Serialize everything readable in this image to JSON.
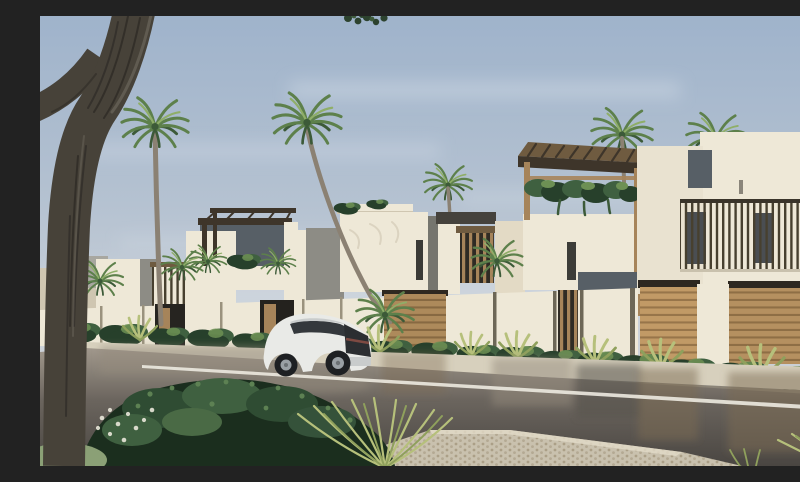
{
  "scene": {
    "description": "Daytime architectural rendering of a receding row of modern cream-white villas with rooftop timber pergolas and hanging greenery, palm trees behind, timber louver screens and slatted garage doors at street level, hedges and agaves along garden walls, a wet asphalt street with a white painted lane line reflecting the buildings, a white luxury SUV driving away, a paver walkway, ornamental grasses and a dense dark shrub in the foreground, and a large leaning tree trunk framing the left edge.",
    "environment": {
      "sky": "clear pale blue with thin cloud haze",
      "lighting": "warm sunlight from the right",
      "street_condition": "wet after rain, reflective"
    },
    "objects": [
      "foreground tree trunk with forked branch",
      "tall date palm trees",
      "row of modern white villas",
      "rooftop wooden pergolas",
      "hanging planter greenery garland",
      "vertical timber louver screen",
      "timber slat garage doors",
      "cream garden walls with timber entry doors",
      "hedge and agave planting strip",
      "concrete curb and far sidewalk",
      "wet asphalt street with reflections",
      "white painted lane line",
      "cobblestone paver walkway",
      "white SUV seen from rear three-quarter",
      "ornamental grass tufts",
      "dense foreground shrub with white blossoms"
    ]
  },
  "palette": {
    "sky_top": "#9fb3cb",
    "sky_mid": "#b5c2d1",
    "sky_horizon": "#ccd2d9",
    "cloud_haze": "#dde4ec",
    "wall_sun": "#eee8d7",
    "wall_warm": "#e3dac5",
    "wall_shade": "#cfc6b1",
    "wall_gray": "#a8a7a0",
    "panel_dark": "#575f66",
    "panel_gray": "#8d8c85",
    "wood_dark": "#3e352a",
    "wood_mid": "#6f5b40",
    "wood_light": "#a6845a",
    "garage_wood": "#c19a66",
    "garage_line": "#906e45",
    "garage_frame": "#2e2820",
    "green_dark": "#27402b",
    "green_mid": "#3f6040",
    "green_light": "#6d9054",
    "palm_green": "#5d804b",
    "palm_dark": "#3c5a38",
    "palm_light": "#8fae68",
    "palm_trunk": "#8b8173",
    "tree_trunk": "#474239",
    "tree_bark_dark": "#2e2b26",
    "tree_edge_light": "#6b665b",
    "road_light": "#a39a8e",
    "road_mid": "#6b655e",
    "road_dark": "#4a4642",
    "reflect_brown": "#7d6b51",
    "reflect_light": "#948c7e",
    "curb_light": "#d7d0bd",
    "curb_shadow": "#8b8477",
    "line_white": "#eae7dd",
    "paver": "#c9c1ae",
    "paver_dot": "#ab9f87",
    "grass_light": "#b6c07b",
    "grass_dark": "#8fa05c",
    "car_white": "#e9eae7",
    "car_shade": "#c9cccc",
    "car_glass": "#34383c",
    "car_dark": "#2b2e31",
    "wheel_dark": "#1e2023",
    "rim_silver": "#9aa0a5",
    "taillight": "#7e4a42",
    "flower_white": "#e9e7da",
    "sage": "#8ba076"
  }
}
